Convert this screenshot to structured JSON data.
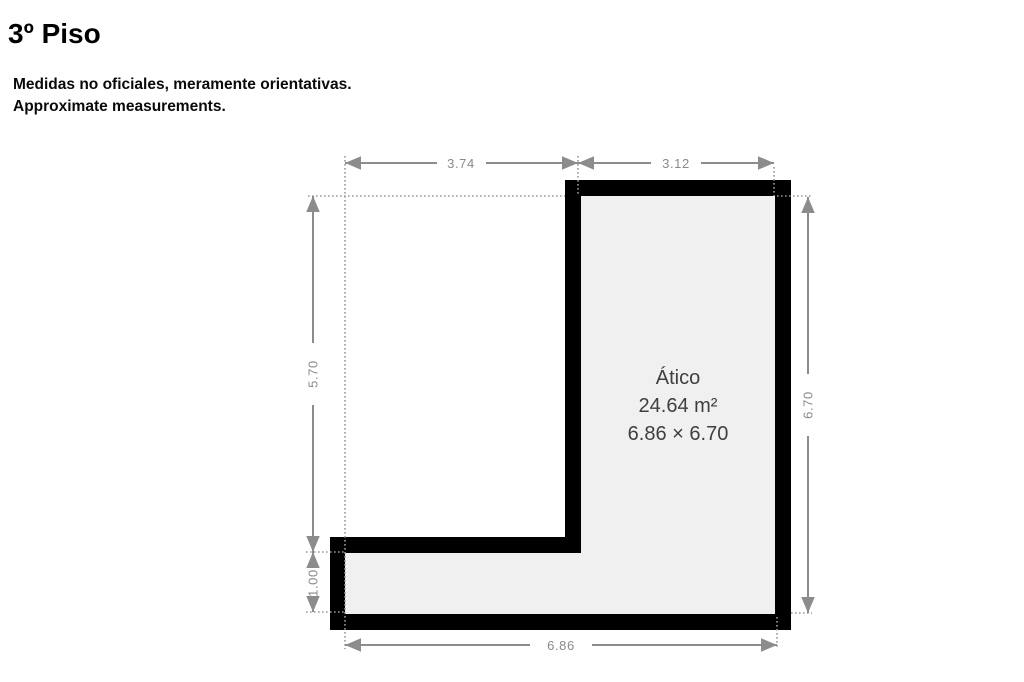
{
  "header": {
    "title": "3º Piso",
    "disclaimer_line1": "Medidas no oficiales, meramente orientativas.",
    "disclaimer_line2": "Approximate measurements."
  },
  "floorplan": {
    "room": {
      "name": "Ático",
      "area": "24.64 m²",
      "size": "6.86 × 6.70"
    },
    "dimensions": {
      "top_left_width": "3.74",
      "top_right_width": "3.12",
      "left_upper_height": "5.70",
      "left_lower_height": "1.00",
      "right_height": "6.70",
      "bottom_width": "6.86"
    },
    "colors": {
      "wall": "#000000",
      "room_fill": "#f0f0f0",
      "dimension_line": "#8c8c8c",
      "dimension_text": "#8a8a8a",
      "room_text": "#3d4043",
      "title_text": "#000000"
    }
  }
}
